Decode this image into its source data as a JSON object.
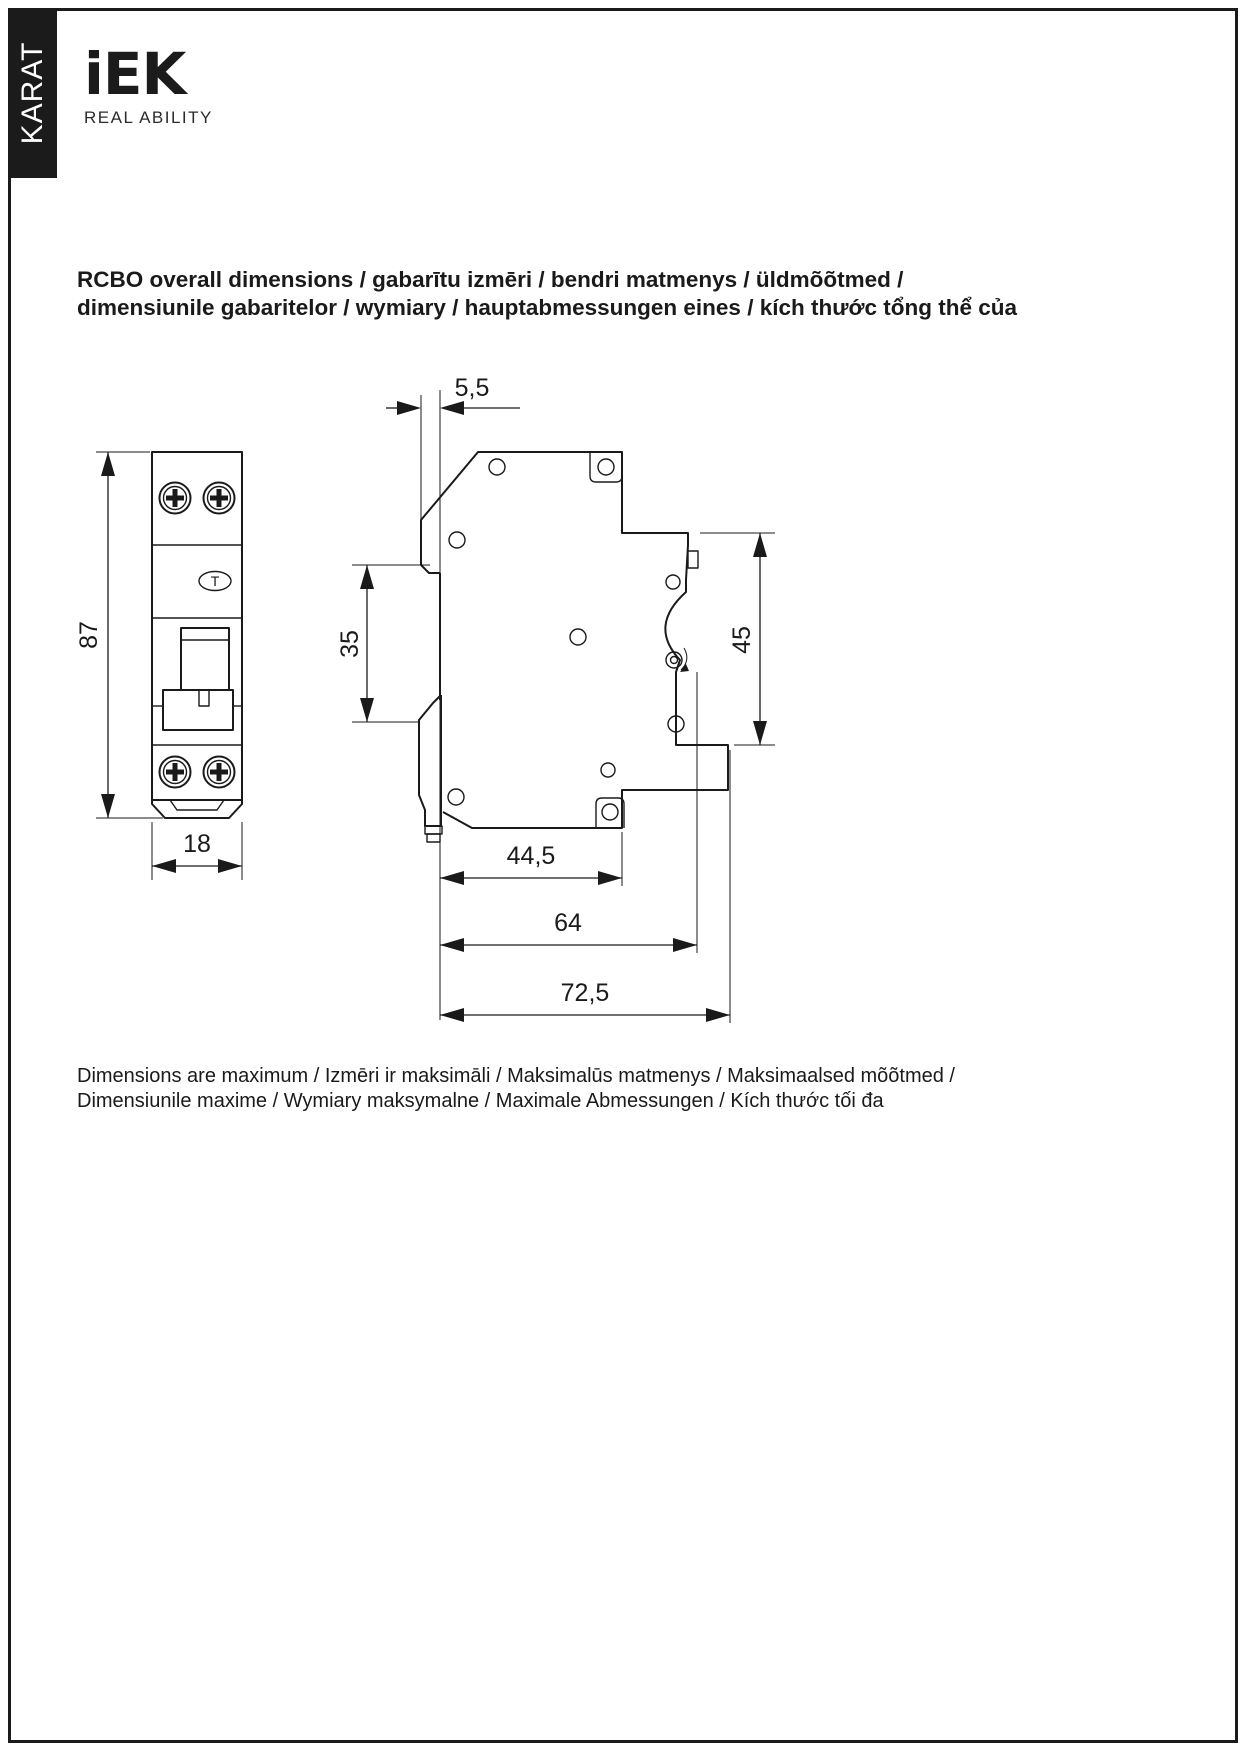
{
  "sidebar": {
    "vertical_label": "KARAT"
  },
  "logo": {
    "brand": "iEK",
    "tagline": "REAL ABILITY"
  },
  "heading": {
    "line1": "RCBO overall dimensions / gabarītu izmēri / bendri matmenys / üldmõõtmed /",
    "line2": "dimensiunile gabaritelor / wymiary / hauptabmessungen eines / kích thước tổng thể của"
  },
  "drawing": {
    "front_view": {
      "height_mm": "87",
      "width_mm": "18",
      "test_button_label": "T"
    },
    "side_view": {
      "top_depth_mm": "5,5",
      "upper_front_mm": "35",
      "din_recess_mm": "45",
      "depth_a_mm": "44,5",
      "depth_b_mm": "64",
      "depth_c_mm": "72,5"
    }
  },
  "footer": {
    "line1": "Dimensions are maximum / Izmēri ir maksimāli / Maksimalūs matmenys / Maksimaalsed mõõtmed /",
    "line2": "Dimensiunile maxime / Wymiary maksymalne / Maximale Abmessungen / Kích thước tối đa"
  },
  "colors": {
    "ink": "#1a1a1a",
    "paper": "#ffffff",
    "band": "#1b1b1b"
  }
}
